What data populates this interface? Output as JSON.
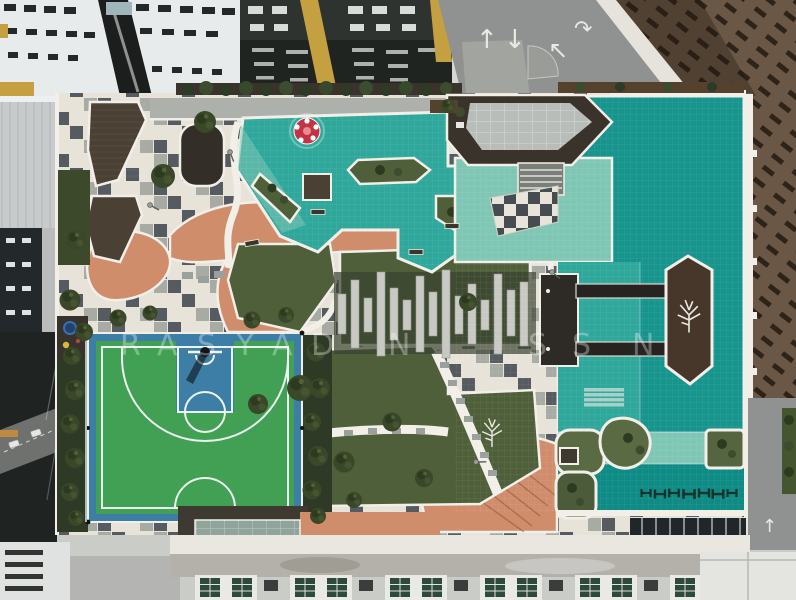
{
  "colors": {
    "pool_deep": "#17948c",
    "pool_mid": "#2fa79b",
    "pool_light": "#7fc7b4",
    "pool_band": "#0e8b84",
    "coping": "#f2efe8",
    "paver_light": "#e7e3d9",
    "paver_dark": "#565b61",
    "paver_mid": "#a8aaa4",
    "terracotta": "#cf8d6c",
    "grass": "#4e5f39",
    "shrub_dark": "#2f3a26",
    "court_green": "#42a055",
    "court_blue": "#3d7ea7",
    "court_line": "#eaf4ee",
    "wood_deck": "#4a4034",
    "island_wood": "#47362a",
    "building_dark": "#2e3330",
    "building_yellow": "#c5a041",
    "building_white": "#e8ebec",
    "building_brown": "#6a5745",
    "road": "#8f9290",
    "roof_gray": "#c7cbcc",
    "mushroom_red": "#c23343",
    "glass": "#b8bdb9",
    "window_green": "#2e4a3d",
    "parapet_white": "#e9e7df",
    "concrete_wall": "#b4b1ab"
  },
  "icons": {
    "arrow_up": "↑",
    "arrow_down": "↓",
    "arrow_upleft": "↖",
    "arrow_turn": "↷"
  },
  "watermark": {
    "y": 328,
    "opacity": 0.32,
    "color": "#ffffff",
    "letters": [
      {
        "ch": "R",
        "x": 120
      },
      {
        "ch": "A",
        "x": 157
      },
      {
        "ch": "S",
        "x": 197
      },
      {
        "ch": "Y",
        "x": 236
      },
      {
        "ch": "A",
        "x": 272
      },
      {
        "ch": "D",
        "x": 311
      },
      {
        "ch": "N",
        "x": 388
      },
      {
        "ch": "S",
        "x": 528
      },
      {
        "ch": "S",
        "x": 572
      },
      {
        "ch": "N",
        "x": 632
      }
    ]
  }
}
